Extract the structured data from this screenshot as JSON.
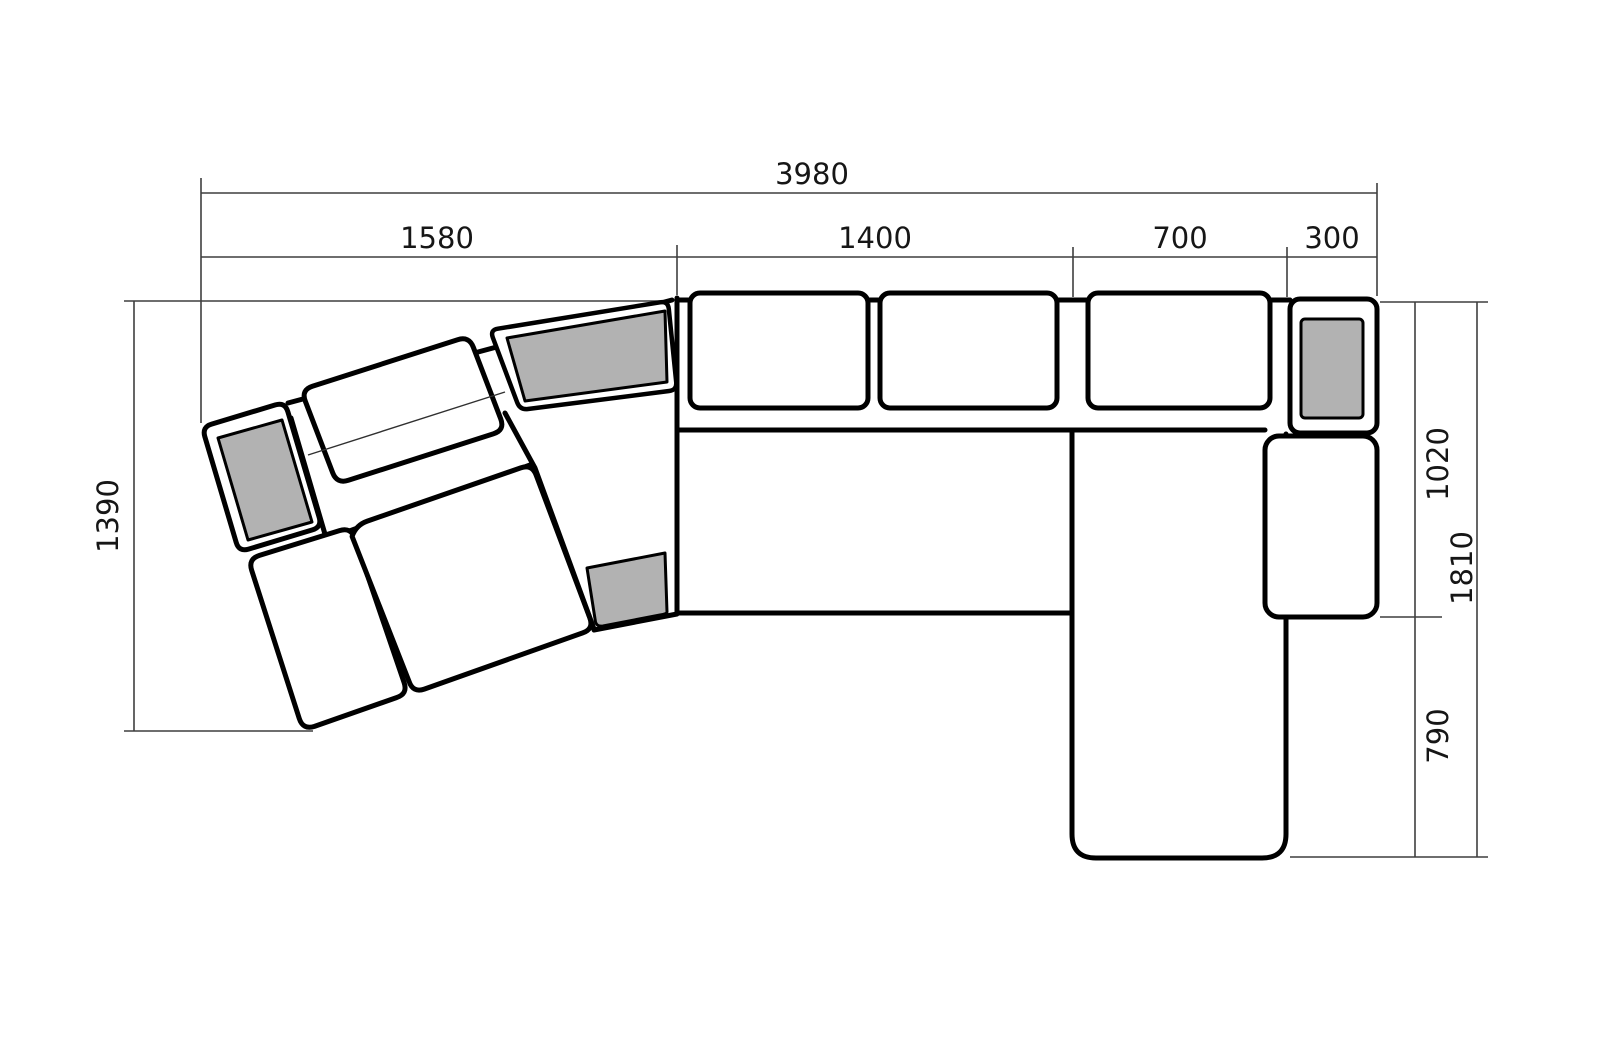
{
  "drawing": {
    "type": "sectional-sofa-plan",
    "units": "mm",
    "colors": {
      "outline": "#000000",
      "dimension_line": "#3f3f3f",
      "cushion_fill": "#b2b2b2",
      "background": "#ffffff"
    }
  },
  "dims": {
    "overall_width": "3980",
    "wing_section_width": "1580",
    "middle_section_width": "1400",
    "seat_section_width": "700",
    "armrest_width": "300",
    "wing_depth": "1390",
    "wing_seat_width": "700",
    "right_depth_upper": "1020",
    "right_depth_total": "1810",
    "chaise_extension": "790"
  }
}
